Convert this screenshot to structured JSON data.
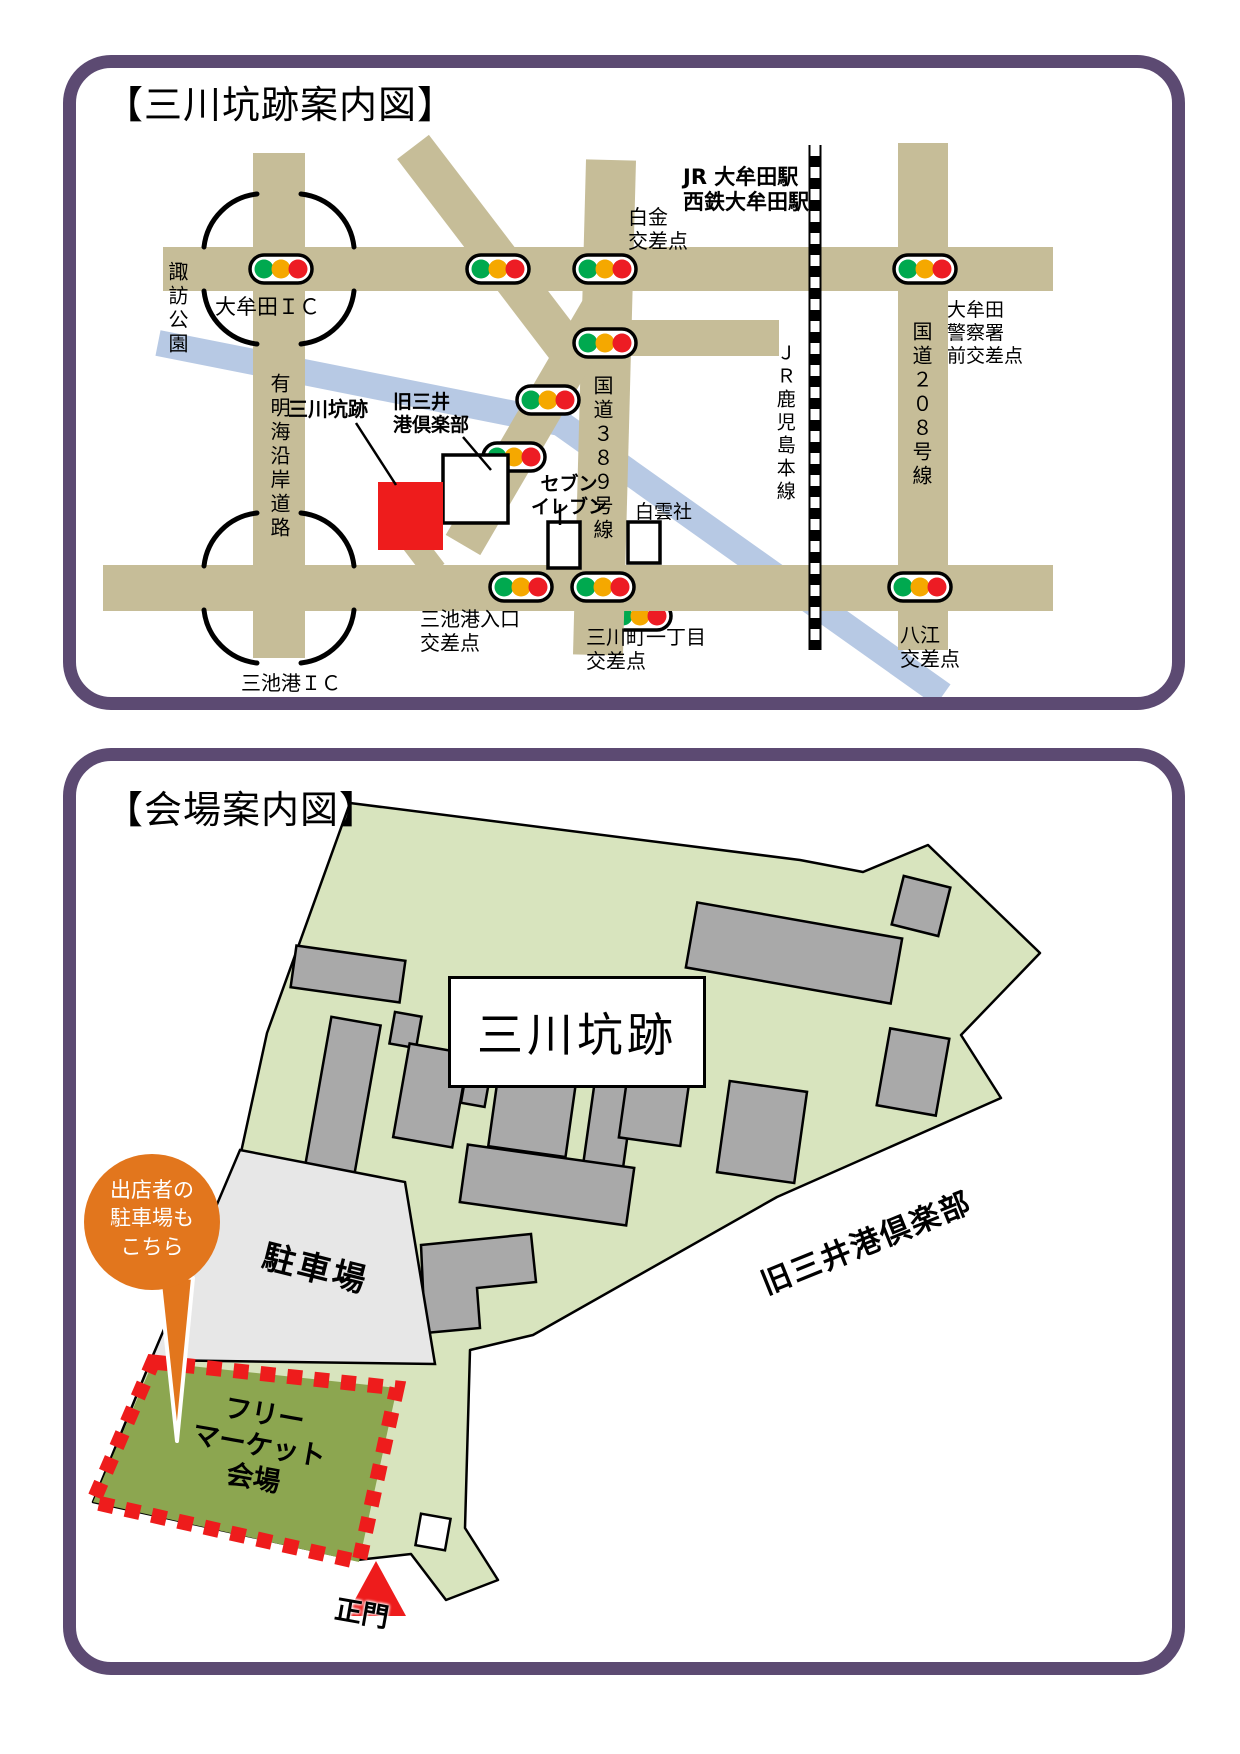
{
  "panel1": {
    "title": "【三川坑跡案内図】",
    "labels": {
      "stations": "JR 大牟田駅\n西鉄大牟田駅",
      "shirakane_crossing": "白金\n交差点",
      "suwa_park": "諏訪公園",
      "omuta_ic": "大牟田ＩＣ",
      "ariake_coast_road": "有明海沿岸道路",
      "kyu_mitsui_club": "旧三井\n港倶楽部",
      "mikawa_pit": "三川坑跡",
      "seven_eleven": "セブン\nイレブン",
      "route_389": "国道３８９号線",
      "hakuunsha": "白雲社",
      "jr_kagoshima_line": "ＪＲ鹿児島本線",
      "route_208": "国道２０８号線",
      "police_front_crossing": "大牟田\n警察署\n前交差点",
      "miike_port_entrance_crossing": "三池港入口\n交差点",
      "mikawamachi_crossing": "三川町一丁目\n交差点",
      "yae_crossing": "八江\n交差点",
      "miike_port_ic": "三池港ＩＣ"
    }
  },
  "panel2": {
    "title": "【会場案内図】",
    "site_name": "三川坑跡",
    "parking_label": "駐車場",
    "flea_market_label": "フリー\nマーケット\n会場",
    "kyu_mitsui_club_label": "旧三井港倶楽部",
    "main_gate_label": "正門",
    "balloon_text": "出店者の\n駐車場も\nこちら"
  },
  "colors": {
    "purple": "#5c4a72",
    "road": "#c6bd98",
    "river": "#b7c9e4",
    "signal-green": "#00a94f",
    "signal-amber": "#f5a800",
    "signal-red": "#ed1c24",
    "map-red": "#ee1c1c",
    "site-green": "#d8e4be",
    "flea-green": "#8ca650",
    "parking-gray": "#e7e7e7",
    "building-gray": "#a9a9a9",
    "balloon-orange": "#e2761d",
    "rail-black": "#000000"
  }
}
